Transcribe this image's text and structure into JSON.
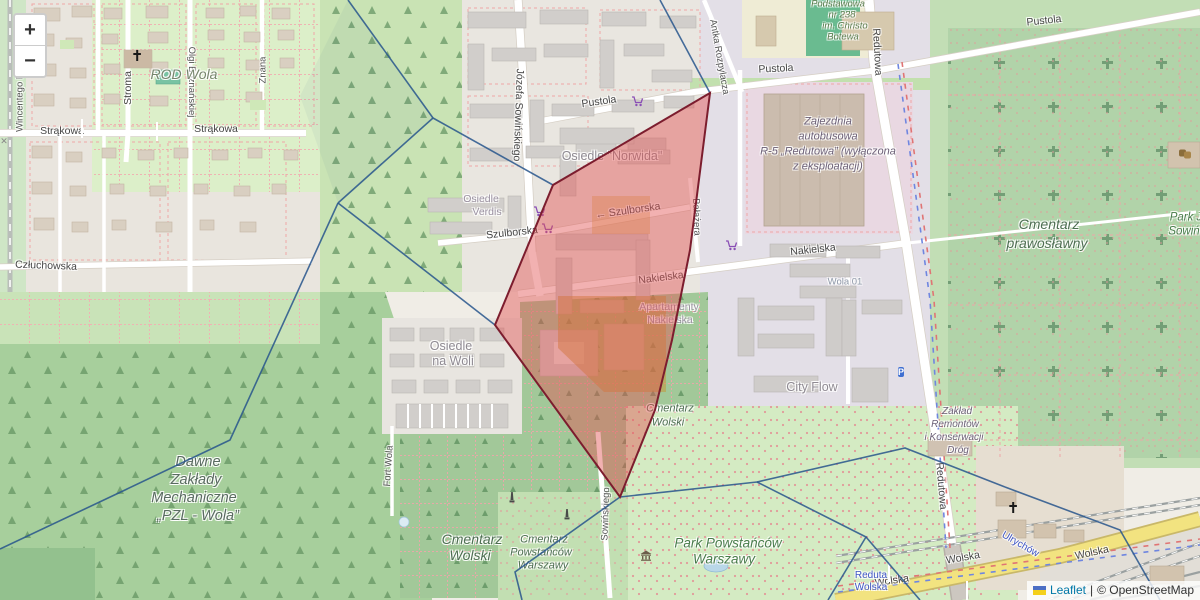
{
  "map": {
    "controls": {
      "zoom_in": "+",
      "zoom_out": "−"
    },
    "attribution": {
      "leaflet": "Leaflet",
      "separator": "|",
      "osm": "© OpenStreetMap"
    },
    "colors": {
      "selected_fill": "rgba(227,82,82,0.45)",
      "selected_stroke": "#7c1d2e",
      "boundary": "#27558c",
      "leaflet_link": "#0078a8",
      "road_yellow": "#f2e380"
    },
    "labels": [
      {
        "text": "Strąkowa",
        "x": 62,
        "y": 131,
        "rot": 0,
        "cls": "street"
      },
      {
        "text": "Strąkowa",
        "x": 216,
        "y": 129,
        "rot": 0,
        "cls": "street"
      },
      {
        "text": "Stroma",
        "x": 128,
        "y": 88,
        "rot": -90,
        "cls": "street"
      },
      {
        "text": "Olgi Boznańskiej",
        "x": 191,
        "y": 82,
        "rot": 90,
        "cls": "street-sm"
      },
      {
        "text": "Wincentego Pola",
        "x": 20,
        "y": 96,
        "rot": -90,
        "cls": "street-sm"
      },
      {
        "text": "Znana",
        "x": 263,
        "y": 70,
        "rot": -90,
        "cls": "street-sm"
      },
      {
        "text": "Człuchowska",
        "x": 46,
        "y": 266,
        "rot": 2,
        "cls": "street"
      },
      {
        "text": "Józefa Sowińskiego",
        "x": 518,
        "y": 115,
        "rot": 92,
        "cls": "street"
      },
      {
        "text": "Antka Rozpylacza",
        "x": 719,
        "y": 57,
        "rot": 80,
        "cls": "street-sm"
      },
      {
        "text": "Pustola",
        "x": 599,
        "y": 102,
        "rot": -8,
        "cls": "street"
      },
      {
        "text": "Pustola",
        "x": 776,
        "y": 69,
        "rot": -3,
        "cls": "street"
      },
      {
        "text": "Pustola",
        "x": 1044,
        "y": 21,
        "rot": -6,
        "cls": "street"
      },
      {
        "text": "Szulborska",
        "x": 512,
        "y": 233,
        "rot": -6,
        "cls": "street"
      },
      {
        "text": "← Szulborska",
        "x": 628,
        "y": 211,
        "rot": -8,
        "cls": "street"
      },
      {
        "text": "Nakielska",
        "x": 661,
        "y": 278,
        "rot": -7,
        "cls": "street"
      },
      {
        "text": "Nakielska",
        "x": 813,
        "y": 250,
        "rot": -6,
        "cls": "street"
      },
      {
        "text": "Bałażera",
        "x": 696,
        "y": 217,
        "rot": 88,
        "cls": "street-sm"
      },
      {
        "text": "Redutowa",
        "x": 877,
        "y": 52,
        "rot": 87,
        "cls": "street"
      },
      {
        "text": "Redutowa",
        "x": 941,
        "y": 486,
        "rot": 85,
        "cls": "street"
      },
      {
        "text": "Fort Wola",
        "x": 389,
        "y": 466,
        "rot": -86,
        "cls": "street-sm"
      },
      {
        "text": "Sowińskiego",
        "x": 606,
        "y": 514,
        "rot": -88,
        "cls": "street-sm"
      },
      {
        "text": "Wolska",
        "x": 892,
        "y": 581,
        "rot": -8,
        "cls": "street"
      },
      {
        "text": "Wolska",
        "x": 963,
        "y": 558,
        "rot": -10,
        "cls": "street"
      },
      {
        "text": "Wolska",
        "x": 1092,
        "y": 553,
        "rot": -12,
        "cls": "street"
      },
      {
        "text": "ROD Wola",
        "x": 184,
        "y": 74,
        "rot": 0,
        "cls": "rod"
      },
      {
        "text": "Osiedle \"Norwida\"",
        "x": 612,
        "y": 156,
        "rot": 0,
        "cls": "place"
      },
      {
        "text": "Osiedle",
        "x": 481,
        "y": 199,
        "rot": 0,
        "cls": "place-sm"
      },
      {
        "text": "Verdis",
        "x": 487,
        "y": 212,
        "rot": 0,
        "cls": "place-sm"
      },
      {
        "text": "Wola 01",
        "x": 845,
        "y": 282,
        "rot": 0,
        "cls": "stop-gray"
      },
      {
        "text": "Apartamenty",
        "x": 669,
        "y": 307,
        "rot": 0,
        "cls": "place-sm"
      },
      {
        "text": "Nakielska",
        "x": 670,
        "y": 320,
        "rot": 0,
        "cls": "place-sm"
      },
      {
        "text": "City Flow",
        "x": 812,
        "y": 387,
        "rot": 0,
        "cls": "place"
      },
      {
        "text": "Osiedle",
        "x": 451,
        "y": 346,
        "rot": 0,
        "cls": "place"
      },
      {
        "text": "na Woli",
        "x": 453,
        "y": 361,
        "rot": 0,
        "cls": "place"
      },
      {
        "text": "Podstawowa",
        "x": 838,
        "y": 4,
        "rot": 0,
        "cls": "school"
      },
      {
        "text": "nr 238",
        "x": 842,
        "y": 15,
        "rot": 0,
        "cls": "school"
      },
      {
        "text": "im. Christo",
        "x": 845,
        "y": 26,
        "rot": 0,
        "cls": "school"
      },
      {
        "text": "Botewa",
        "x": 843,
        "y": 37,
        "rot": 0,
        "cls": "school"
      },
      {
        "text": "Zajezdnia",
        "x": 828,
        "y": 122,
        "rot": 0,
        "cls": "industrial"
      },
      {
        "text": "autobusowa",
        "x": 828,
        "y": 137,
        "rot": 0,
        "cls": "industrial"
      },
      {
        "text": "R-5 „Redutowa” (wyłączona",
        "x": 828,
        "y": 152,
        "rot": 0,
        "cls": "industrial"
      },
      {
        "text": "z eksploatacji)",
        "x": 828,
        "y": 167,
        "rot": 0,
        "cls": "industrial"
      },
      {
        "text": "Cmentarz",
        "x": 1049,
        "y": 224,
        "rot": 0,
        "cls": "cemetery-lg"
      },
      {
        "text": "prawosławny",
        "x": 1047,
        "y": 243,
        "rot": 0,
        "cls": "cemetery-lg"
      },
      {
        "text": "Park J",
        "x": 1186,
        "y": 218,
        "rot": 0,
        "cls": "park"
      },
      {
        "text": "Sowiń",
        "x": 1184,
        "y": 232,
        "rot": 0,
        "cls": "park"
      },
      {
        "text": "Cmentarz",
        "x": 670,
        "y": 409,
        "rot": 0,
        "cls": "cemetery"
      },
      {
        "text": "Wolski",
        "x": 668,
        "y": 423,
        "rot": 0,
        "cls": "cemetery"
      },
      {
        "text": "Cmentarz",
        "x": 472,
        "y": 539,
        "rot": 0,
        "cls": "cemetery-lg"
      },
      {
        "text": "Wolski",
        "x": 470,
        "y": 555,
        "rot": 0,
        "cls": "cemetery-lg"
      },
      {
        "text": "Cmentarz",
        "x": 544,
        "y": 540,
        "rot": 0,
        "cls": "cemetery"
      },
      {
        "text": "Powstańców",
        "x": 541,
        "y": 553,
        "rot": 0,
        "cls": "cemetery"
      },
      {
        "text": "Warszawy",
        "x": 543,
        "y": 566,
        "rot": 0,
        "cls": "cemetery"
      },
      {
        "text": "Park Powstańców",
        "x": 728,
        "y": 543,
        "rot": 0,
        "cls": "park-lg"
      },
      {
        "text": "Warszawy",
        "x": 724,
        "y": 559,
        "rot": 0,
        "cls": "park-lg"
      },
      {
        "text": "Dawne",
        "x": 198,
        "y": 462,
        "rot": 0,
        "cls": "industrial-lg"
      },
      {
        "text": "Zakłady",
        "x": 196,
        "y": 480,
        "rot": 0,
        "cls": "industrial-lg"
      },
      {
        "text": "Mechaniczne",
        "x": 194,
        "y": 498,
        "rot": 0,
        "cls": "industrial-lg"
      },
      {
        "text": "„PZL - Wola”",
        "x": 198,
        "y": 516,
        "rot": 0,
        "cls": "industrial-lg"
      },
      {
        "text": "Zakład",
        "x": 957,
        "y": 412,
        "rot": 0,
        "cls": "industrial-sm"
      },
      {
        "text": "Remontów",
        "x": 955,
        "y": 425,
        "rot": 0,
        "cls": "industrial-sm"
      },
      {
        "text": "i Konserwacji",
        "x": 954,
        "y": 438,
        "rot": 0,
        "cls": "industrial-sm"
      },
      {
        "text": "Dróg",
        "x": 958,
        "y": 451,
        "rot": 0,
        "cls": "industrial-sm"
      },
      {
        "text": "Reduta",
        "x": 871,
        "y": 576,
        "rot": 0,
        "cls": "blue-stop"
      },
      {
        "text": "Wolska",
        "x": 871,
        "y": 588,
        "rot": 0,
        "cls": "blue-stop"
      },
      {
        "text": "Ulrychów",
        "x": 1020,
        "y": 545,
        "rot": 30,
        "cls": "blue-stop"
      }
    ],
    "icons": [
      {
        "type": "cart",
        "x": 539,
        "y": 213
      },
      {
        "type": "cart",
        "x": 547,
        "y": 230
      },
      {
        "type": "cart",
        "x": 637,
        "y": 103
      },
      {
        "type": "cart",
        "x": 731,
        "y": 247
      },
      {
        "type": "church",
        "x": 137,
        "y": 58
      },
      {
        "type": "church",
        "x": 1013,
        "y": 510
      },
      {
        "type": "parking",
        "x": 901,
        "y": 371,
        "glyph": "P"
      },
      {
        "type": "museum",
        "x": 646,
        "y": 557
      },
      {
        "type": "monument",
        "x": 512,
        "y": 500
      },
      {
        "type": "monument",
        "x": 567,
        "y": 517
      },
      {
        "type": "bus",
        "x": 82,
        "y": 129
      },
      {
        "type": "bus",
        "x": 157,
        "y": 132
      },
      {
        "type": "bus",
        "x": 889,
        "y": 573
      },
      {
        "type": "bus",
        "x": 967,
        "y": 591
      },
      {
        "type": "xing",
        "x": 4,
        "y": 140,
        "glyph": "✕"
      },
      {
        "type": "theatre",
        "x": 1185,
        "y": 155
      }
    ],
    "overlays": {
      "selected_cell": {
        "points": [
          [
            710,
            93
          ],
          [
            553,
            185
          ],
          [
            495,
            325
          ],
          [
            620,
            497
          ],
          [
            655,
            410
          ],
          [
            672,
            340
          ],
          [
            690,
            250
          ]
        ]
      },
      "voronoi_edges": [
        [
          [
            348,
            0
          ],
          [
            433,
            118
          ]
        ],
        [
          [
            433,
            118
          ],
          [
            338,
            203
          ]
        ],
        [
          [
            338,
            203
          ],
          [
            230,
            440
          ],
          [
            125,
            490
          ],
          [
            0,
            549
          ]
        ],
        [
          [
            433,
            118
          ],
          [
            553,
            185
          ]
        ],
        [
          [
            338,
            203
          ],
          [
            495,
            325
          ]
        ],
        [
          [
            710,
            93
          ],
          [
            688,
            52
          ],
          [
            660,
            0
          ]
        ],
        [
          [
            620,
            497
          ],
          [
            515,
            572
          ],
          [
            522,
            600
          ]
        ],
        [
          [
            620,
            497
          ],
          [
            757,
            482
          ]
        ],
        [
          [
            757,
            482
          ],
          [
            905,
            448
          ],
          [
            1005,
            487
          ]
        ],
        [
          [
            1005,
            487
          ],
          [
            1120,
            530
          ],
          [
            1160,
            600
          ]
        ],
        [
          [
            757,
            482
          ],
          [
            866,
            537
          ],
          [
            828,
            600
          ]
        ],
        [
          [
            866,
            537
          ],
          [
            920,
            600
          ]
        ]
      ]
    }
  }
}
